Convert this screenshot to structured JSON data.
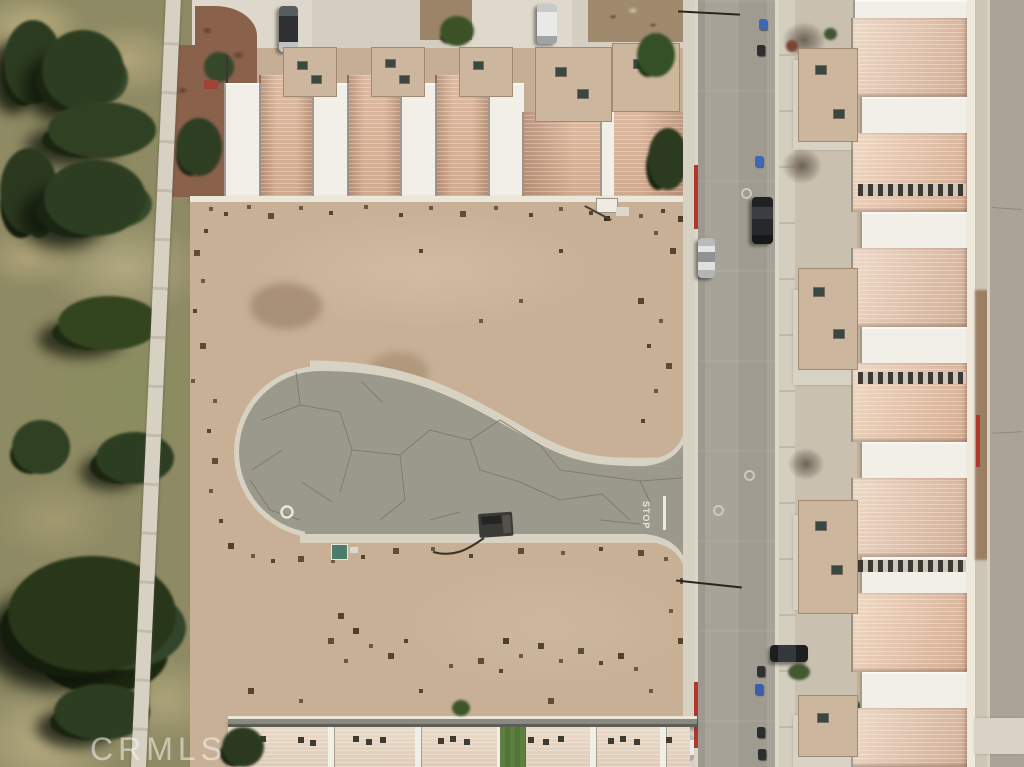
{
  "watermark": {
    "text": "CRMLS"
  },
  "road_markings": {
    "stop_label": "STOP"
  },
  "scene": {
    "type": "aerial-photo",
    "subject": "vacant-lot-with-cul-de-sac"
  },
  "palette": {
    "golf_grass": "#8e8a63",
    "tree_green": "#2d3d21",
    "dirt_lot": "#c7b096",
    "culdesac_asphalt": "#9b998c",
    "street_asphalt": "#a5a096",
    "concrete": "#d8d2c5",
    "roof_tile_salmon": "#e3c4ad",
    "roof_white": "#f1efe8",
    "roof_tan": "#ccb69e",
    "red_curb": "#b0372c",
    "mulch_red": "#8a614b",
    "lawn_green": "#5d8040",
    "bin_blue": "#3f67b5"
  }
}
